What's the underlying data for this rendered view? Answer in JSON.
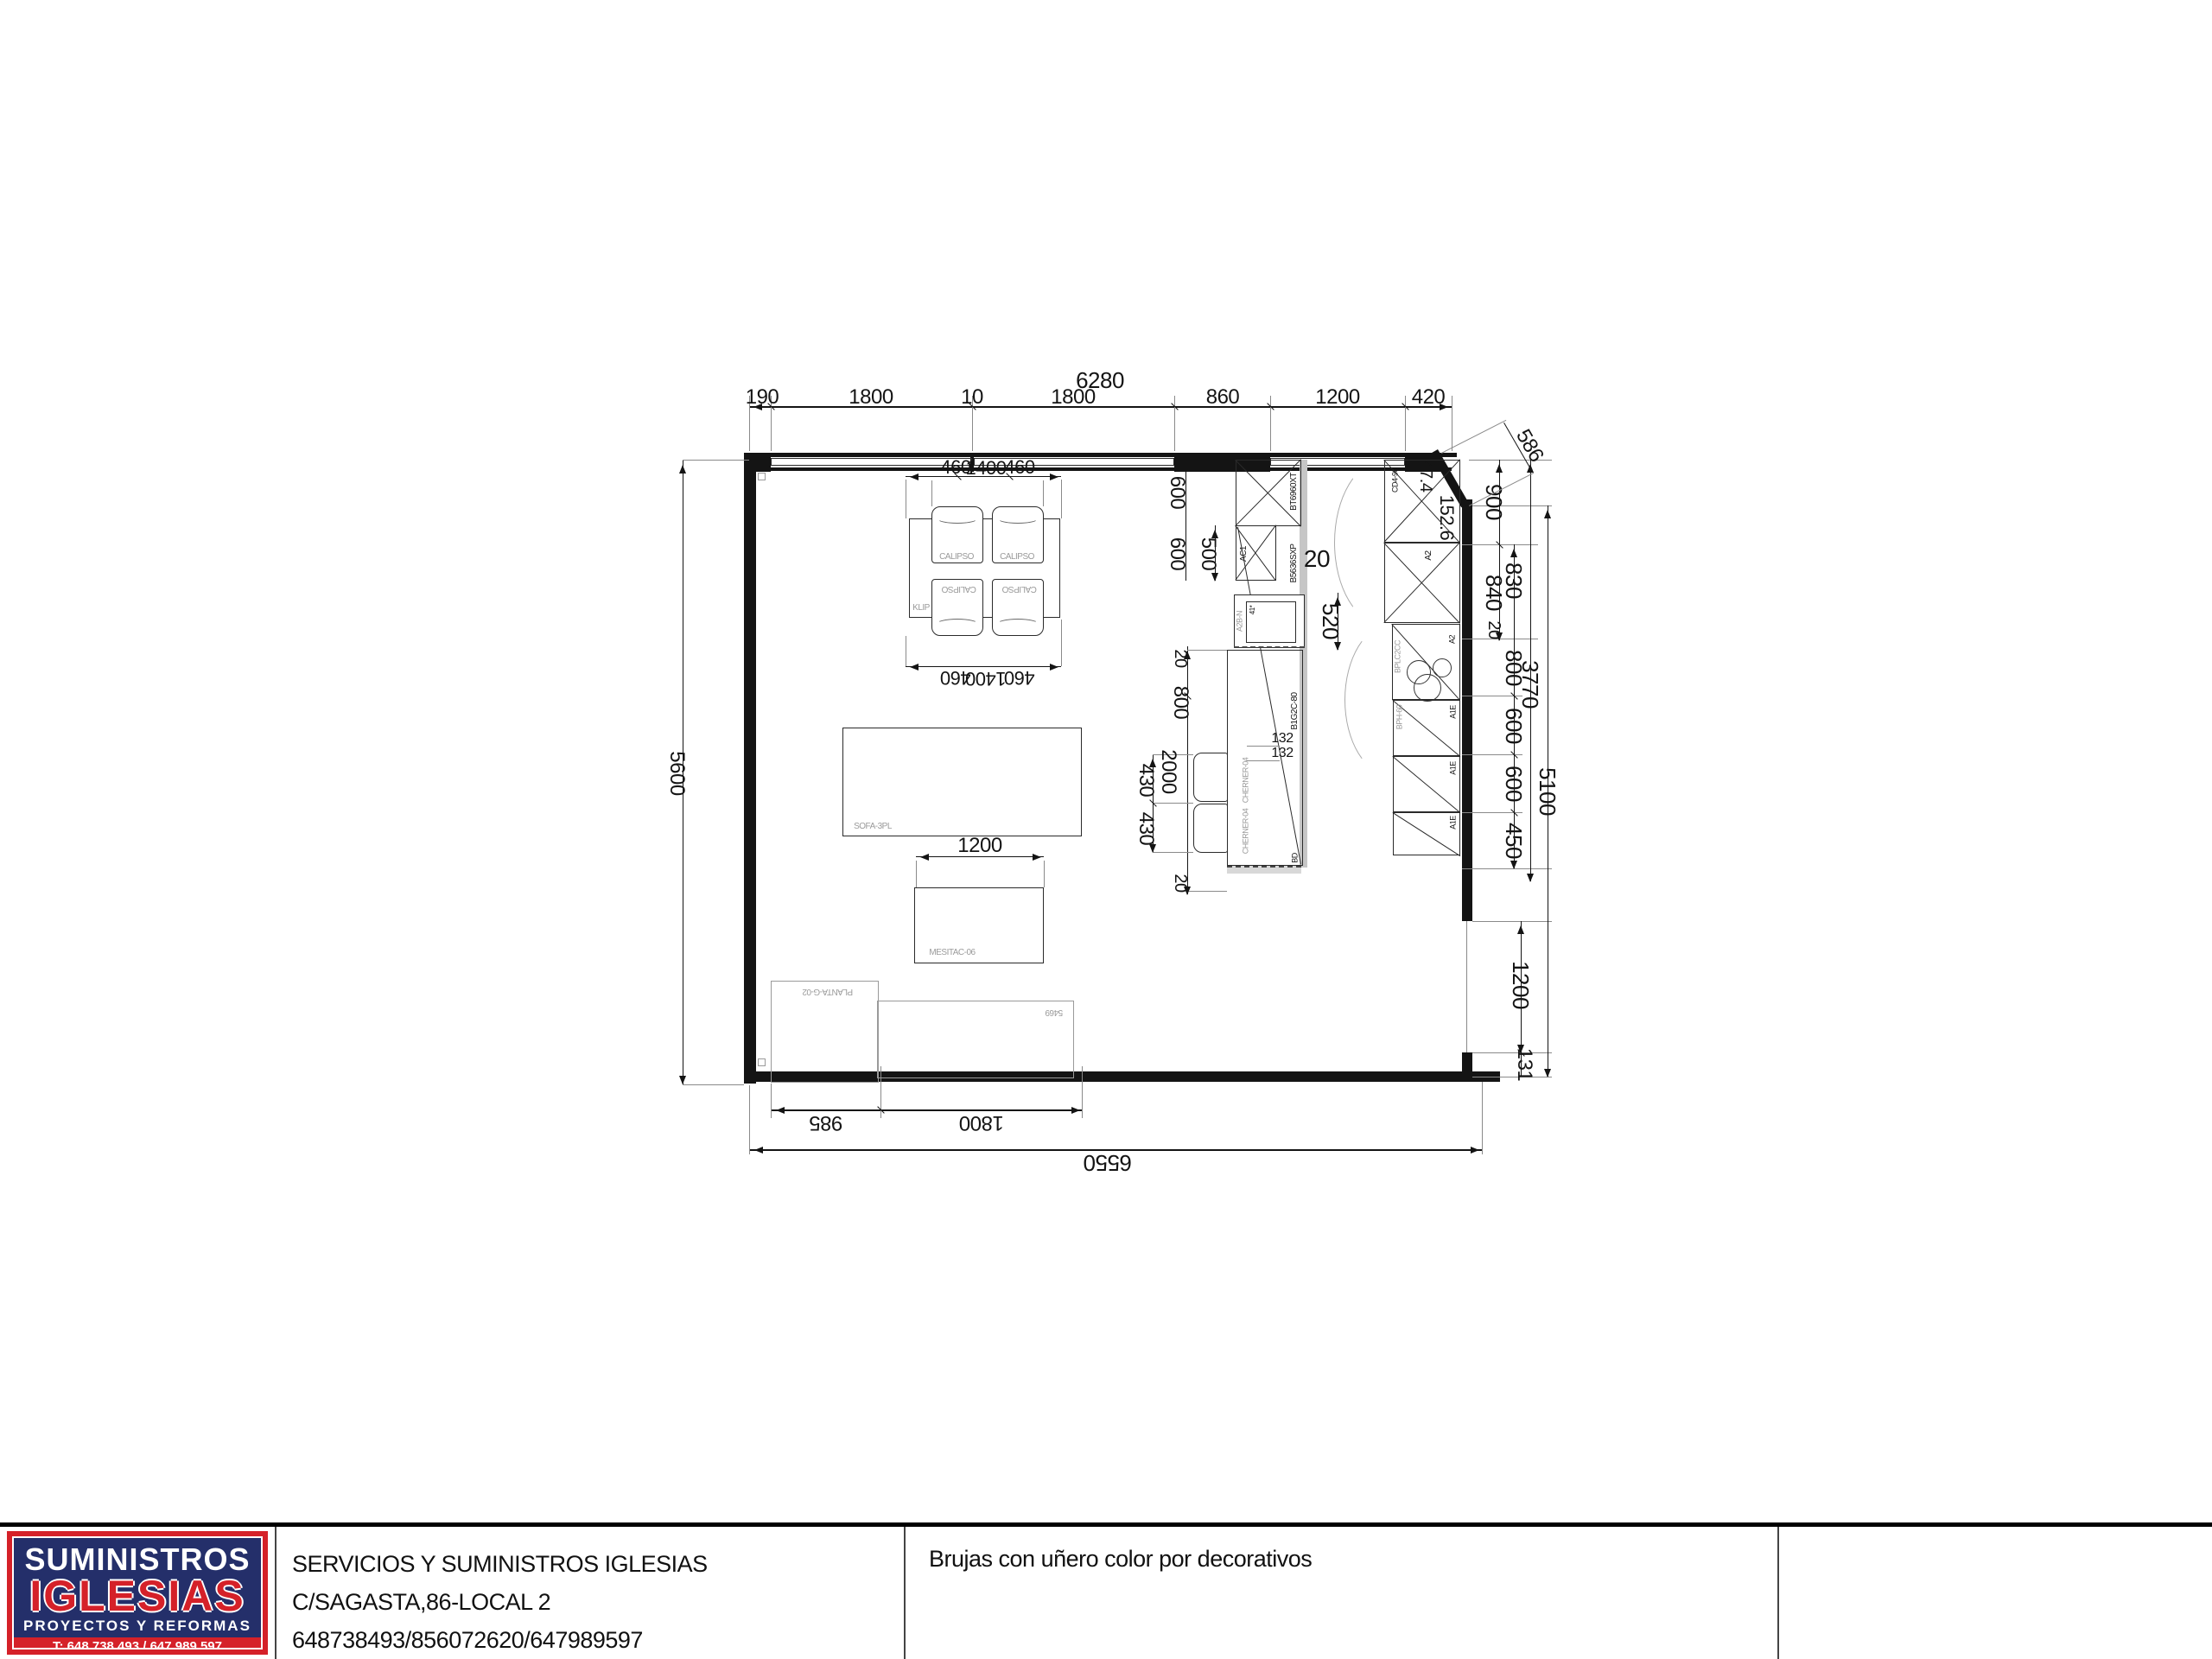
{
  "colors": {
    "logo_navy": "#242f6a",
    "logo_red": "#d52129",
    "label_grey": "#9a9a9a",
    "line": "#141414"
  },
  "title_block": {
    "logo": {
      "brand_top": "SUMINISTROS",
      "brand_main": "IGLESIAS",
      "tagline": "PROYECTOS Y REFORMAS",
      "phone": "T: 648 738 493 / 647 989 597",
      "address": "Sagasta, 86 (Callejones Cardoso) - Cádiz Centro"
    },
    "company_name": "SERVICIOS Y SUMINISTROS IGLESIAS",
    "company_address": "C/SAGASTA,86-LOCAL 2",
    "company_phones": "648738493/856072620/647989597",
    "description": "Brujas con uñero color por decorativos"
  },
  "dims": {
    "top_total": "6280",
    "top_segments": [
      "190",
      "1800",
      "10",
      "1800",
      "860",
      "1200",
      "420"
    ],
    "table_top": [
      "460",
      "1400",
      "460"
    ],
    "table_bottom": [
      "460",
      "1400",
      "460"
    ],
    "left_total": "5600",
    "bottom_segments": [
      "985",
      "1800"
    ],
    "bottom_total": "6550",
    "right_inner": [
      "900",
      "840",
      "20"
    ],
    "right_outer": [
      "830",
      "800",
      "600",
      "600",
      "450"
    ],
    "right_door": [
      "1200",
      "131"
    ],
    "right_total_inner": "3770",
    "right_total_outer": "5100",
    "corner": {
      "angled": "586",
      "a": "47.4",
      "b": "152.6"
    },
    "center": {
      "c600a": "600",
      "c600b": "600",
      "c500": "500",
      "c20": "20",
      "c520": "520"
    },
    "island": {
      "i20a": "20",
      "i800": "800",
      "i2000": "2000",
      "i430a": "430",
      "i430b": "430",
      "i20b": "20",
      "i132a": "132",
      "i132b": "132"
    },
    "coffee_width": "1200",
    "sink_note": "41*"
  },
  "furniture": {
    "dining_table": "KLIP",
    "dining_chair": "CALIPSO",
    "sofa": "SOFA-3PL",
    "coffee_table": "MESITAC-06",
    "planter": "PLANTA-G-02",
    "rug": "5469",
    "fridge": "BT6960XT",
    "tall_unit": "B5636SXP",
    "wall_unit": "AC1",
    "sink_unit": "A2B-N",
    "island": "B1G2C-80",
    "island_stool": "CHERNER-04",
    "island_end": "BD",
    "corner_unit": "CD4-90",
    "base_a2": "A2",
    "hob_unit": "BPLC2CC",
    "hob_base": "BPH-60",
    "base_a1e": "A1E"
  }
}
